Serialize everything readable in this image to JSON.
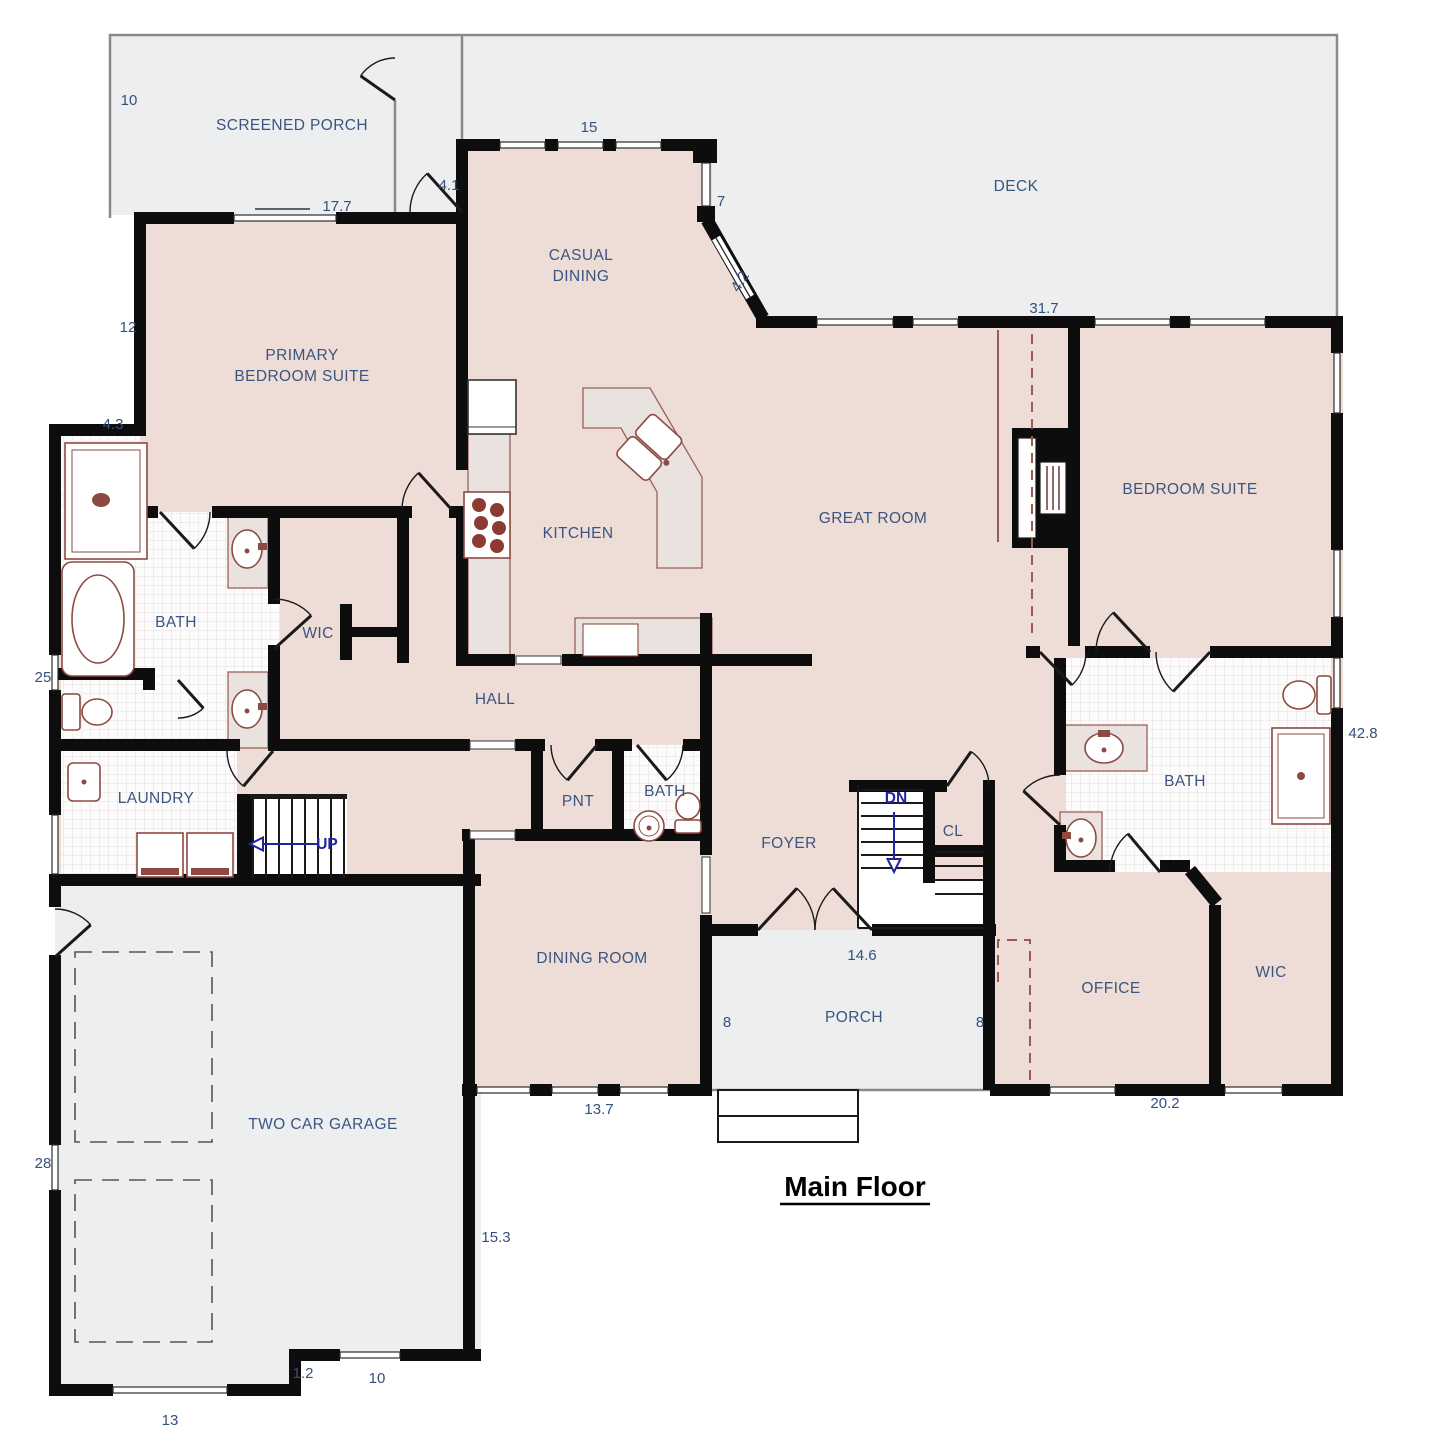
{
  "title": {
    "text": "Main Floor",
    "x": 855,
    "y": 1196
  },
  "plan": {
    "room_labels": [
      {
        "id": "screened-porch",
        "lines": [
          "SCREENED PORCH"
        ],
        "x": 292,
        "y": 130
      },
      {
        "id": "deck",
        "lines": [
          "DECK"
        ],
        "x": 1016,
        "y": 191
      },
      {
        "id": "casual-dining",
        "lines": [
          "CASUAL",
          "DINING"
        ],
        "x": 581,
        "y": 260
      },
      {
        "id": "primary-bedroom-suite",
        "lines": [
          "PRIMARY",
          "BEDROOM SUITE"
        ],
        "x": 302,
        "y": 360
      },
      {
        "id": "bedroom-suite",
        "lines": [
          "BEDROOM SUITE"
        ],
        "x": 1190,
        "y": 494
      },
      {
        "id": "kitchen",
        "lines": [
          "KITCHEN"
        ],
        "x": 578,
        "y": 538
      },
      {
        "id": "great-room",
        "lines": [
          "GREAT ROOM"
        ],
        "x": 873,
        "y": 523
      },
      {
        "id": "bath-primary",
        "lines": [
          "BATH"
        ],
        "x": 176,
        "y": 627
      },
      {
        "id": "wic-primary",
        "lines": [
          "WIC"
        ],
        "x": 318,
        "y": 638
      },
      {
        "id": "hall",
        "lines": [
          "HALL"
        ],
        "x": 495,
        "y": 704
      },
      {
        "id": "laundry",
        "lines": [
          "LAUNDRY"
        ],
        "x": 156,
        "y": 803
      },
      {
        "id": "pnt",
        "lines": [
          "PNT"
        ],
        "x": 578,
        "y": 806
      },
      {
        "id": "bath-powder",
        "lines": [
          "BATH"
        ],
        "x": 665,
        "y": 796
      },
      {
        "id": "foyer",
        "lines": [
          "FOYER"
        ],
        "x": 789,
        "y": 848
      },
      {
        "id": "cl",
        "lines": [
          "CL"
        ],
        "x": 953,
        "y": 836
      },
      {
        "id": "dining-room",
        "lines": [
          "DINING ROOM"
        ],
        "x": 592,
        "y": 963
      },
      {
        "id": "porch",
        "lines": [
          "PORCH"
        ],
        "x": 854,
        "y": 1022
      },
      {
        "id": "office",
        "lines": [
          "OFFICE"
        ],
        "x": 1111,
        "y": 993
      },
      {
        "id": "wic-right",
        "lines": [
          "WIC"
        ],
        "x": 1271,
        "y": 977
      },
      {
        "id": "bath-right",
        "lines": [
          "BATH"
        ],
        "x": 1185,
        "y": 786
      },
      {
        "id": "two-car-garage",
        "lines": [
          "TWO CAR GARAGE"
        ],
        "x": 323,
        "y": 1129
      }
    ],
    "stairs": [
      {
        "id": "up",
        "text": "UP",
        "x": 327,
        "y": 849
      },
      {
        "id": "dn",
        "text": "DN",
        "x": 896,
        "y": 803
      }
    ],
    "dimensions": [
      {
        "text": "10",
        "x": 129,
        "y": 105
      },
      {
        "text": "17.7",
        "x": 337,
        "y": 211
      },
      {
        "text": "15",
        "x": 589,
        "y": 132
      },
      {
        "text": "4.1",
        "x": 449,
        "y": 190
      },
      {
        "text": "7",
        "x": 721,
        "y": 206
      },
      {
        "text": "4.2",
        "x": 744,
        "y": 284,
        "rot": -58
      },
      {
        "text": "31.7",
        "x": 1044,
        "y": 313
      },
      {
        "text": "12",
        "x": 128,
        "y": 332
      },
      {
        "text": "4.3",
        "x": 113,
        "y": 429
      },
      {
        "text": "25",
        "x": 43,
        "y": 682
      },
      {
        "text": "42.8",
        "x": 1363,
        "y": 738
      },
      {
        "text": "14.6",
        "x": 862,
        "y": 960
      },
      {
        "text": "8",
        "x": 727,
        "y": 1027
      },
      {
        "text": "8",
        "x": 980,
        "y": 1027
      },
      {
        "text": "13.7",
        "x": 599,
        "y": 1114
      },
      {
        "text": "20.2",
        "x": 1165,
        "y": 1108
      },
      {
        "text": "28",
        "x": 43,
        "y": 1168
      },
      {
        "text": "15.3",
        "x": 496,
        "y": 1242
      },
      {
        "text": "1.2",
        "x": 303,
        "y": 1378
      },
      {
        "text": "10",
        "x": 377,
        "y": 1383
      },
      {
        "text": "13",
        "x": 170,
        "y": 1425
      }
    ],
    "colors": {
      "wall": "#0d0d0d",
      "interior": "#eedcd6",
      "outdoor": "#eceef0",
      "tile": "#fdfcfc",
      "fixture": "#8d4a42",
      "counter": "#e9e2df",
      "label_blue": "#3a5580",
      "stair_navy": "#20249d",
      "title_black": "#000000"
    }
  }
}
